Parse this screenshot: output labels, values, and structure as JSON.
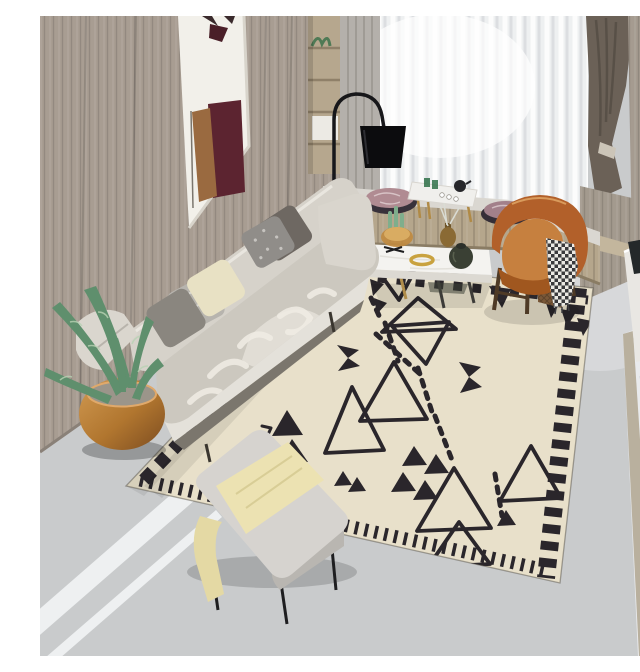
{
  "scene": {
    "caption": "Modern living room photo: beige fabric sofa with gray and cream pillows, black arc floor lamp, white marble coffee table, cognac leather armchair, window seat with sheer curtains, potted aloe in a copper bowl, gray ottoman with yellow blanket, on a cream Moroccan-style rug with black geometric triangles."
  },
  "colors": {
    "floor": "#c9cbcc",
    "floorStripe": "#eef0f1",
    "marbleRight": "#e9eaec",
    "seam": "#b9b09e",
    "woodWall": "#a89d92",
    "alcove": "#f2f0ea",
    "artMaroon": "#5c2430",
    "artWood": "#9a6a40",
    "shelfWood": "#b6a78e",
    "sheer": "#eef0f1",
    "curtainGray": "#b4b0ab",
    "curtainDark": "#6b6157",
    "pillarWood": "#a59b90",
    "darkShelf": "#131417",
    "sideTable": "#e9e7e3",
    "benchMarble": "#dad7d1",
    "benchWood": "#b5a68c",
    "cushionPink": "#b08b92",
    "trayWhite": "#f0efec",
    "lampBlack": "#0c0c0e",
    "rugBase": "#e8e0ca",
    "rugPattern": "#2a262b",
    "sofaBack": "#d6d2ca",
    "sofaSeat": "#ccc8bf",
    "sofaBase": "#e4e1da",
    "pillowDark": "#6e6862",
    "pillowHound": "#908d89",
    "pillowCream": "#e8e1c4",
    "pillowLeaf": "#b7b4ae",
    "pillowGray": "#8a867f",
    "potCopper": "#c08a45",
    "plantGreen": "#5f8f6d",
    "soil": "#9b958a",
    "tableWhite": "#f4f3f0",
    "bowlGold": "#c08a3e",
    "vaseOlive": "#3a4034",
    "ringGold": "#c9a23f",
    "chairOrange": "#b2602a",
    "chairInner": "#c6803f",
    "rattan": "#7a5838",
    "throwWhite": "#ebe9e4",
    "ottoman": "#d6d3cf",
    "blanketYellow": "#ece2b2",
    "glassGreen": "#3f7d4c",
    "booksPink": "#efece8"
  },
  "objects": [
    {
      "id": "wood-panel-wall",
      "label": "wood panel wall"
    },
    {
      "id": "alcove-artwork",
      "label": "white alcove with maroon artwork"
    },
    {
      "id": "wall-shelf-unit",
      "label": "small wall shelf with plant and boxes"
    },
    {
      "id": "window-sheer-curtains",
      "label": "sheer white curtains"
    },
    {
      "id": "dark-curtain",
      "label": "dark taupe curtain"
    },
    {
      "id": "arc-floor-lamp",
      "label": "black arc floor lamp"
    },
    {
      "id": "window-bench",
      "label": "marble-top window bench"
    },
    {
      "id": "round-cushions",
      "label": "round pink marbled cushions"
    },
    {
      "id": "tea-tray-table",
      "label": "white tea tray table with teapot"
    },
    {
      "id": "sofa",
      "label": "beige three-seat sofa"
    },
    {
      "id": "sofa-pillows",
      "label": "five throw pillows"
    },
    {
      "id": "aloe-plant",
      "label": "aloe plant in copper bowl"
    },
    {
      "id": "coffee-table",
      "label": "white marble coffee table"
    },
    {
      "id": "geometric-rug",
      "label": "cream rug with black triangles"
    },
    {
      "id": "leather-armchair",
      "label": "cognac leather armchair"
    },
    {
      "id": "houndstooth-throw",
      "label": "houndstooth throw"
    },
    {
      "id": "ottoman-bench",
      "label": "gray ottoman with yellow blanket"
    },
    {
      "id": "side-table-right",
      "label": "white side table with green vase and books"
    },
    {
      "id": "floor-books",
      "label": "books leaning at right edge"
    }
  ]
}
